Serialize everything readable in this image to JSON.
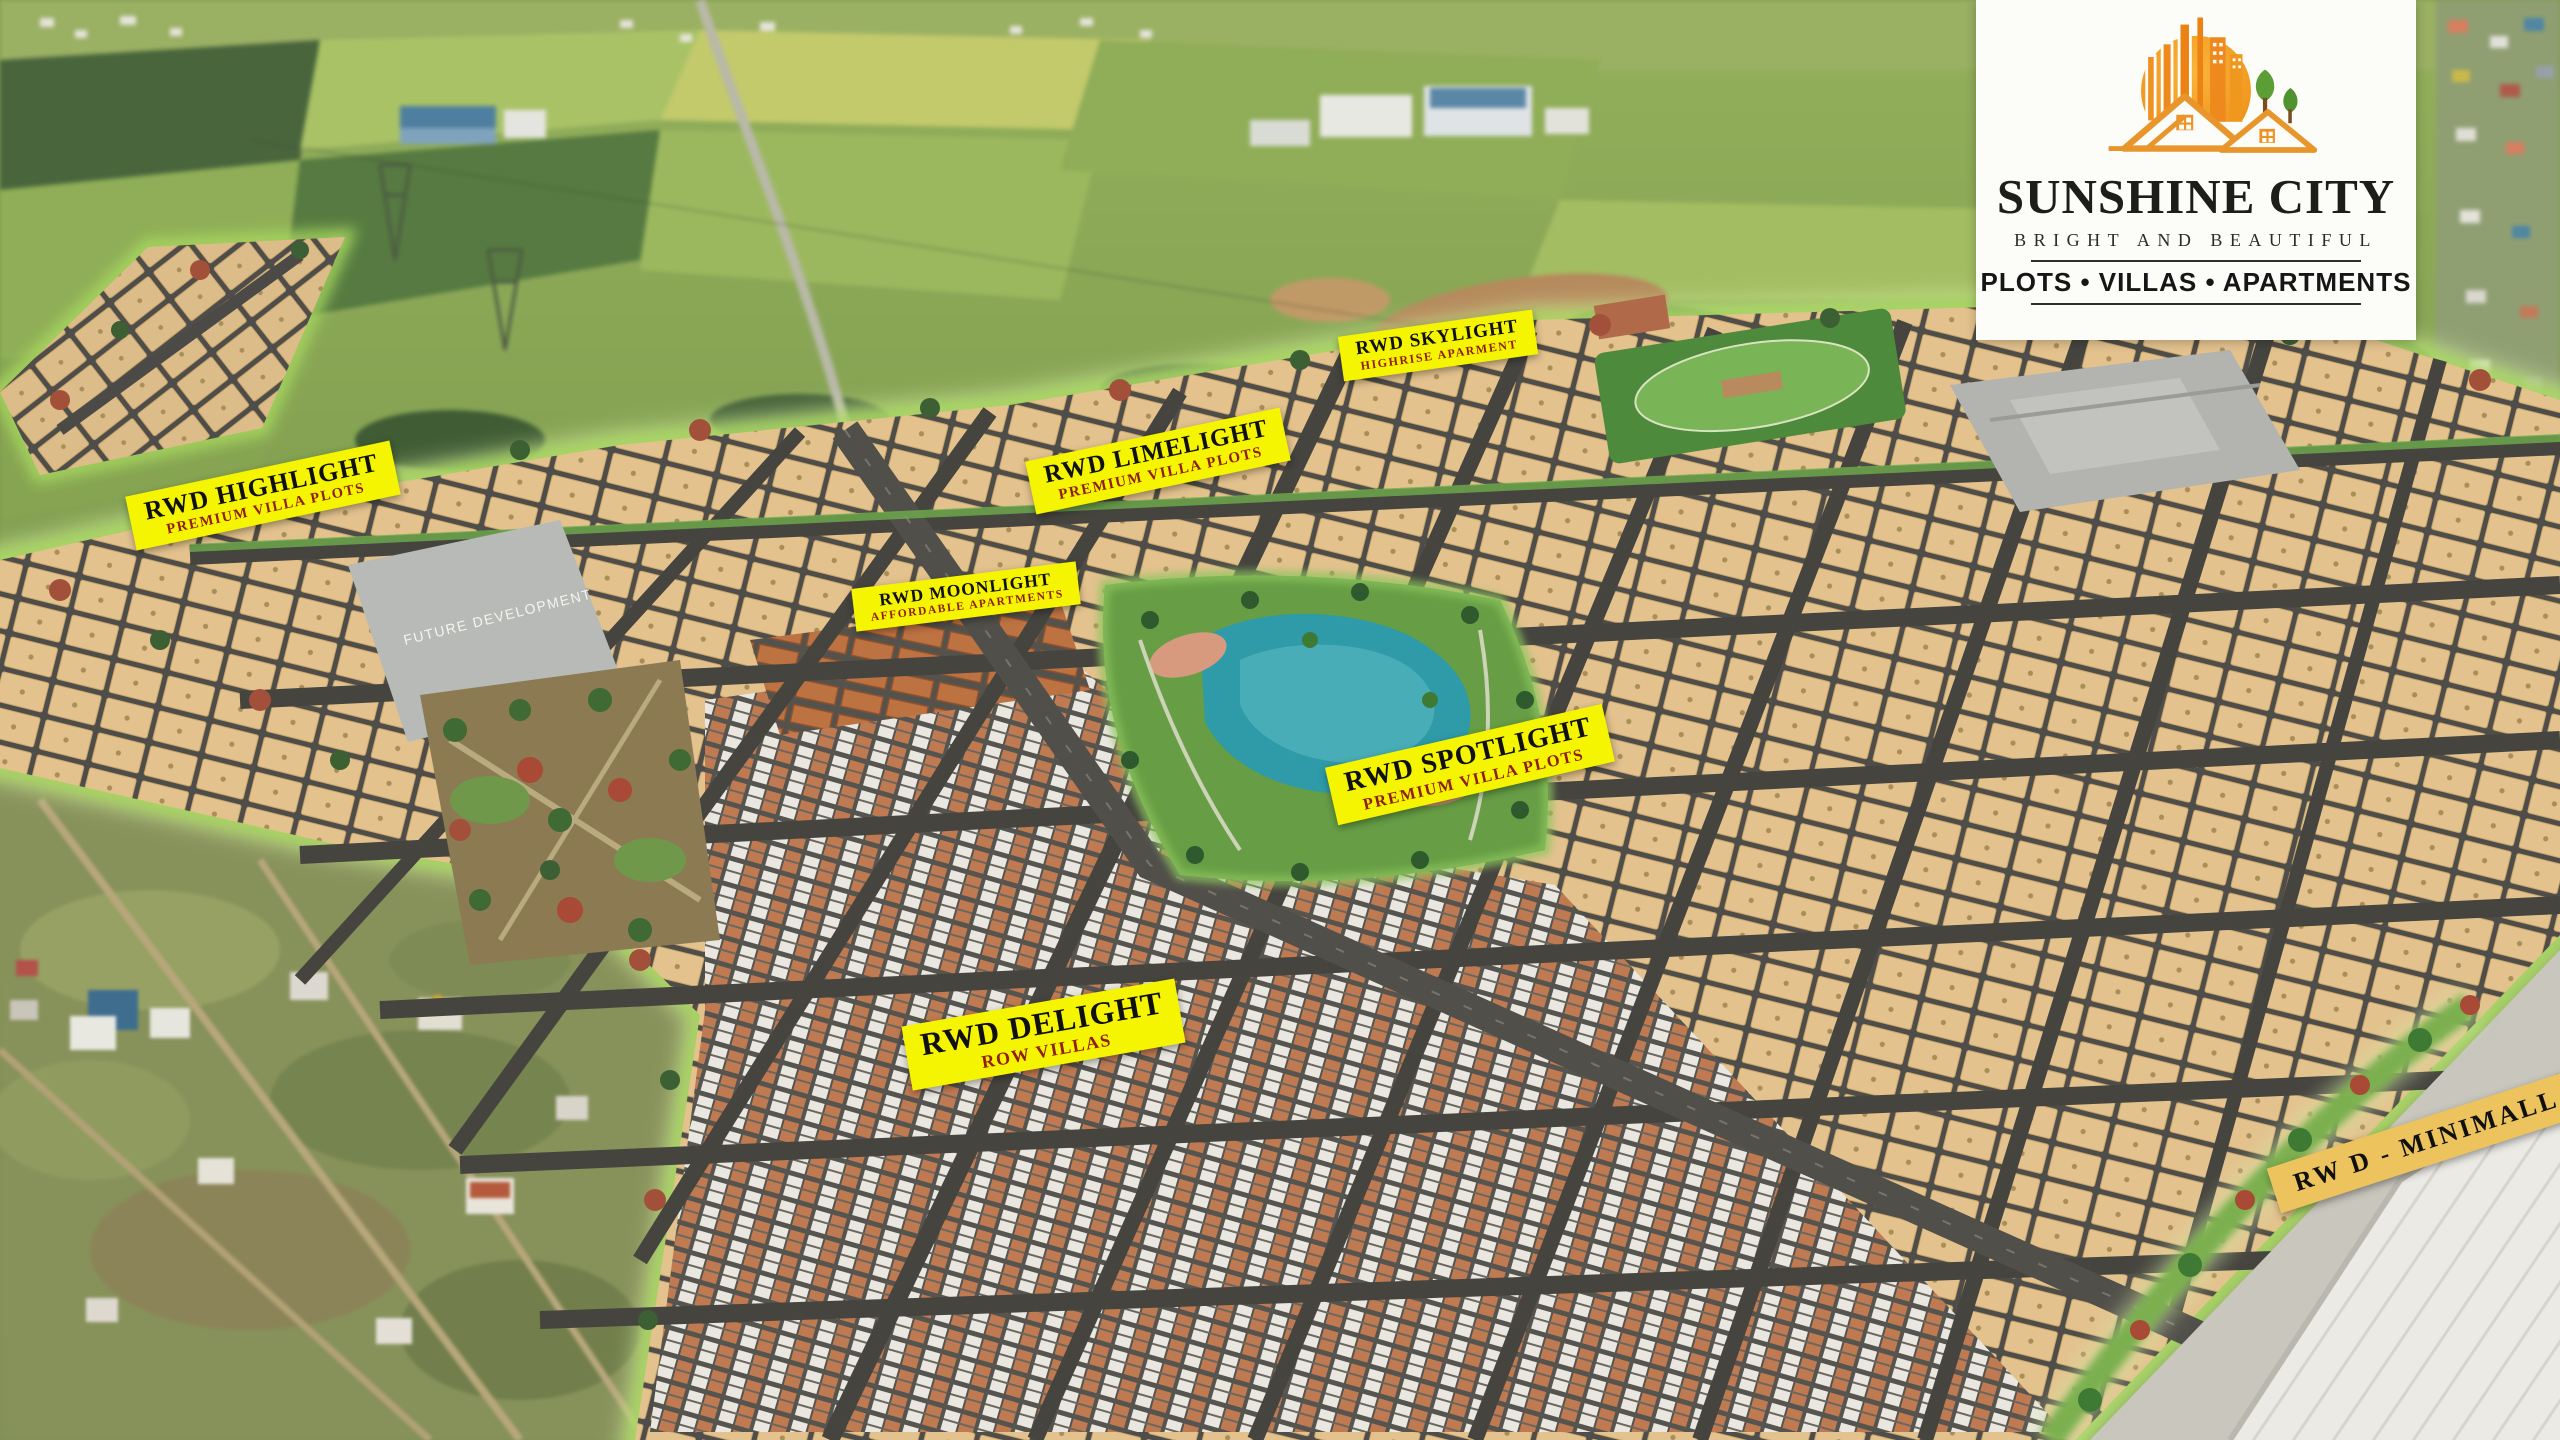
{
  "logo": {
    "title": "SUNSHINE CITY",
    "tagline": "BRIGHT AND BEAUTIFUL",
    "categories": "PLOTS • VILLAS • APARTMENTS",
    "icon": "sun-buildings-houses-trees-icon",
    "colors": {
      "sun_top": "#f9b43a",
      "sun_bottom": "#ec8214",
      "text": "#1d1d1b",
      "card_bg": "#fcfcf8"
    }
  },
  "labels": [
    {
      "id": "highlight",
      "title": "RWD HIGHLIGHT",
      "subtitle": "PREMIUM VILLA PLOTS"
    },
    {
      "id": "skylight",
      "title": "RWD SKYLIGHT",
      "subtitle": "HIGHRISE APARMENT"
    },
    {
      "id": "limelight",
      "title": "RWD LIMELIGHT",
      "subtitle": "PREMIUM VILLA PLOTS"
    },
    {
      "id": "moonlight",
      "title": "RWD MOONLIGHT",
      "subtitle": "AFFORDABLE APARTMENTS"
    },
    {
      "id": "spotlight",
      "title": "RWD SPOTLIGHT",
      "subtitle": "PREMIUM VILLA PLOTS"
    },
    {
      "id": "delight",
      "title": "RWD DELIGHT",
      "subtitle": "ROW VILLAS"
    },
    {
      "id": "minimall",
      "title": "RW D - MINIMALL",
      "subtitle": ""
    }
  ],
  "areas": {
    "future_development": "FUTURE DEVELOPMENT"
  },
  "colors": {
    "label_yellow": "#f6f501",
    "label_gold": "#ecc35c",
    "label_title": "#101010",
    "label_subtitle": "#8f1d10",
    "road": "#4b4a46",
    "plot_tan": "#e3c28e",
    "park_green": "#679e45",
    "lake_teal": "#2f9aa8",
    "boundary_glow": "#a8d95e"
  }
}
